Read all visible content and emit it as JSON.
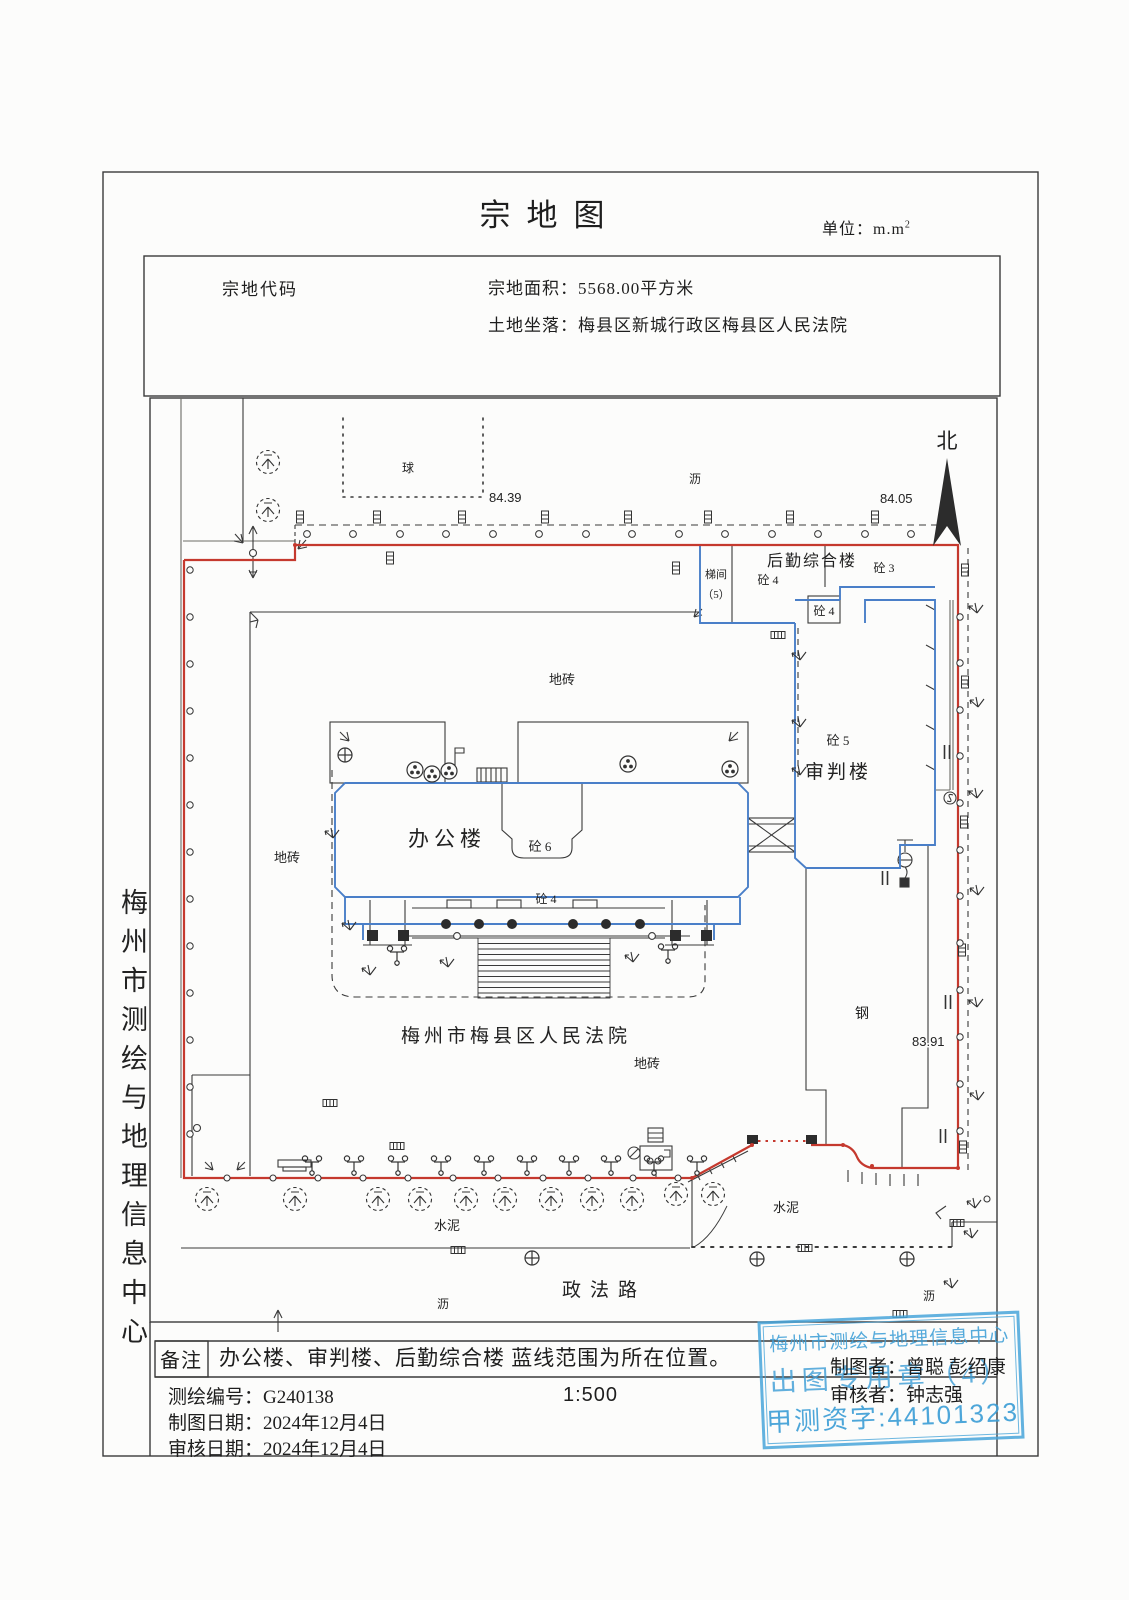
{
  "header": {
    "title": "宗地图",
    "unit_prefix": "单位：m.m",
    "unit_sup": "2"
  },
  "info": {
    "parcel_code": "宗地代码",
    "area": "宗地面积：5568.00平方米",
    "location": "土地坐落：梅县区新城行政区梅县区人民法院"
  },
  "map": {
    "north": "北",
    "ball_court": "球",
    "elev_top_left": "84.39",
    "elev_top_right": "84.05",
    "elev_right": "83.91",
    "asphalt": "沥",
    "tile": "地砖",
    "cement": "水泥",
    "steel": "钢",
    "road": "政法路",
    "court_name": "梅州市梅县区人民法院",
    "office": "办公楼",
    "trial": "审判楼",
    "logistics": "后勤综合楼",
    "stair": "梯间",
    "stair_no": "（5）",
    "c3": "砼 3",
    "c4": "砼 4",
    "c5": "砼 5",
    "c6": "砼 6"
  },
  "sidebar": {
    "org": "梅州市测绘与地理信息中心"
  },
  "footer": {
    "remark_label": "备注",
    "remark": "办公楼、审判楼、后勤综合楼 蓝线范围为所在位置。",
    "survey_no": "测绘编号：G240138",
    "scale": "1:500",
    "draw_date": "制图日期：2024年12月4日",
    "review_date": "审核日期：2024年12月4日",
    "drafter": "制图者：曾聪 彭绍康",
    "reviewer": "审核者：钟志强"
  },
  "stamp": {
    "org": "梅州市测绘与地理信息中心",
    "seal": "出图专用章（4）",
    "cert": "甲测资字:44101323"
  },
  "colors": {
    "boundary_red": "#c5392e",
    "building_blue": "#4a7fc8",
    "stamp_blue": "#4aa6db"
  }
}
